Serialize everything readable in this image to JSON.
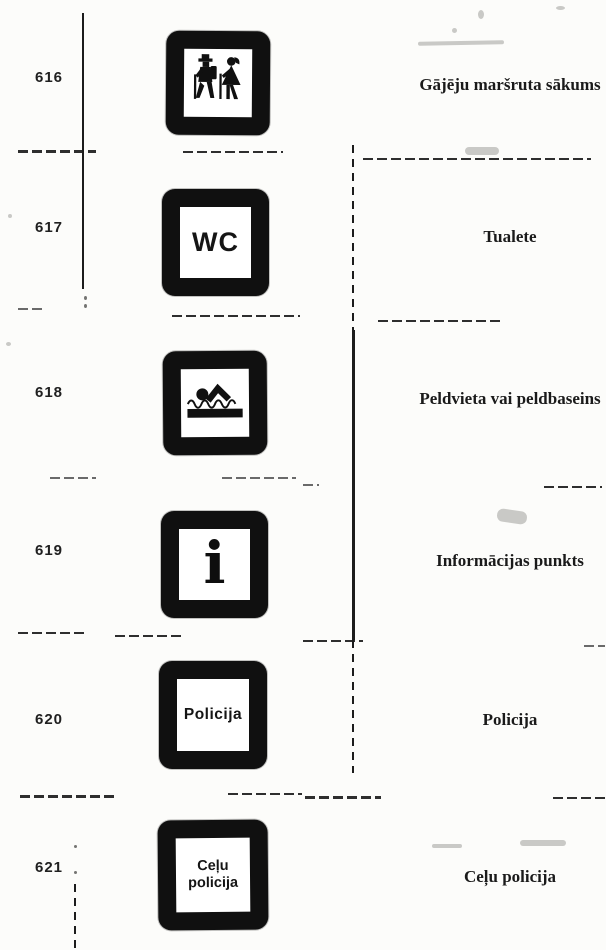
{
  "document": {
    "kind": "Scanned catalogue page of Latvian road service signs",
    "paper_color": "#fcfcfa",
    "ink_color": "#161616"
  },
  "rows": [
    {
      "number": "616",
      "icon": "hikers-icon",
      "description": "Gājēju maršruta sākums"
    },
    {
      "number": "617",
      "icon": "wc-sign-icon",
      "sign_text": "WC",
      "description": "Tualete"
    },
    {
      "number": "618",
      "icon": "swimmer-icon",
      "description": "Peldvieta vai peldbaseins"
    },
    {
      "number": "619",
      "icon": "information-icon",
      "sign_text": "i",
      "description": "Informācijas punkts"
    },
    {
      "number": "620",
      "icon": "police-plate-icon",
      "sign_text": "Policija",
      "description": "Policija"
    },
    {
      "number": "621",
      "icon": "traffic-police-plate-icon",
      "sign_line1": "Ceļu",
      "sign_line2": "policija",
      "description": "Ceļu policija"
    }
  ]
}
